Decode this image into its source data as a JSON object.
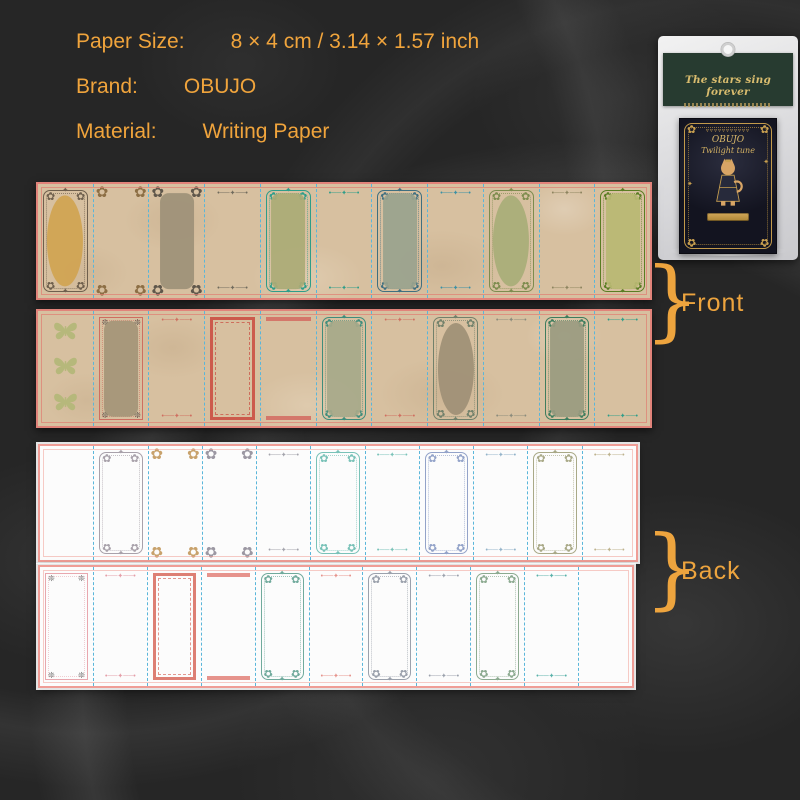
{
  "info": {
    "rows": [
      {
        "label": "Paper Size:",
        "value": "8 × 4 cm / 3.14 × 1.57 inch"
      },
      {
        "label": "Brand:",
        "value": "OBUJO"
      },
      {
        "label": "Material:",
        "value": "Writing Paper"
      }
    ]
  },
  "package": {
    "header_title": "The stars sing forever",
    "notepad_brand": "OBUJO",
    "notepad_series": "Twilight tune"
  },
  "annotations": {
    "front": "Front",
    "back": "Back",
    "brace": "}"
  },
  "ornaments": {
    "corner": "✿",
    "star": "✦",
    "line": "•──✦──•",
    "snow": "❊",
    "bunting": "▿▿▿▿▿▿▿▿▿▿▿"
  },
  "colors": {
    "accent_orange": "#eda43e",
    "kraft_paper": "#d7c0a0",
    "strip_border_red": "#e1837a",
    "divider_blue": "#5ab6da",
    "back_paper": "#fcfcfc",
    "card_green": "#273b30",
    "gold": "#c9a050",
    "notepad_dark": "#131420"
  },
  "strips": [
    {
      "name": "front-strip-top",
      "panels": [
        {
          "t": "ornate",
          "f": "#6e5f4d",
          "c": "oval",
          "cc": "#d1a452"
        },
        {
          "t": "corner",
          "f": "#8d6f45"
        },
        {
          "t": "corner",
          "f": "#5f574b",
          "c": "rrect",
          "cc": "#9e9179"
        },
        {
          "t": "line",
          "f": "#6f6a5c"
        },
        {
          "t": "ornate",
          "f": "#2e9d89",
          "c": "rrect",
          "cc": "#abab76"
        },
        {
          "t": "line",
          "f": "#2e9d89"
        },
        {
          "t": "ornate",
          "f": "#3f6f80",
          "c": "rrect",
          "cc": "#9aa38e"
        },
        {
          "t": "line",
          "f": "#3a90a5"
        },
        {
          "t": "ornate",
          "f": "#7d8c4e",
          "c": "oval",
          "cc": "#a9ad78"
        },
        {
          "t": "line",
          "f": "#8d845f"
        },
        {
          "t": "ornate",
          "f": "#5a7d22",
          "c": "rrect",
          "cc": "#b9b873"
        }
      ]
    },
    {
      "name": "front-strip-bottom",
      "panels": [
        {
          "t": "butterflies",
          "f": "#b6b87b"
        },
        {
          "t": "rectcorner",
          "f": "#cf6e60",
          "cg": "#55504a",
          "c": "rrect",
          "cc": "#a59478"
        },
        {
          "t": "line",
          "f": "#cf6e60"
        },
        {
          "t": "rect",
          "f": "#cc5a4c"
        },
        {
          "t": "bars",
          "f": "#d4776a"
        },
        {
          "t": "ornate",
          "f": "#3f8d7c",
          "c": "rrect",
          "cc": "#a7a98a"
        },
        {
          "t": "line",
          "f": "#cf6e60"
        },
        {
          "t": "ornate",
          "f": "#72816b",
          "c": "oval",
          "cc": "#9f9076"
        },
        {
          "t": "line",
          "f": "#8b8b7c"
        },
        {
          "t": "ornate",
          "f": "#3e7d5e",
          "c": "rrect",
          "cc": "#9a9b80"
        },
        {
          "t": "line",
          "f": "#2e9d89"
        }
      ]
    },
    {
      "name": "back-strip-top",
      "panels": [
        {
          "t": "none"
        },
        {
          "t": "ornate",
          "f": "#a8a1aa"
        },
        {
          "t": "corner",
          "f": "#c8a26c"
        },
        {
          "t": "corner",
          "f": "#9c98a3"
        },
        {
          "t": "line",
          "f": "#a3a3ab"
        },
        {
          "t": "ornate",
          "f": "#79c2b8"
        },
        {
          "t": "line",
          "f": "#79c2b8"
        },
        {
          "t": "ornate",
          "f": "#93a3c9"
        },
        {
          "t": "line",
          "f": "#93b3c9"
        },
        {
          "t": "ornate",
          "f": "#a9a987"
        },
        {
          "t": "line",
          "f": "#bdb28d"
        }
      ]
    },
    {
      "name": "back-strip-bottom",
      "panels": [
        {
          "t": "rectcorner",
          "f": "#e8a7ae",
          "cg": "#6a6a6a"
        },
        {
          "t": "line",
          "f": "#e49ea8"
        },
        {
          "t": "rect",
          "f": "#dd7f74"
        },
        {
          "t": "bars",
          "f": "#e6938c"
        },
        {
          "t": "ornate",
          "f": "#70aa9c"
        },
        {
          "t": "line",
          "f": "#e6938c"
        },
        {
          "t": "ornate",
          "f": "#9ba1ac"
        },
        {
          "t": "line",
          "f": "#9ba1ac"
        },
        {
          "t": "ornate",
          "f": "#8caa90"
        },
        {
          "t": "line",
          "f": "#58b1a9"
        },
        {
          "t": "none"
        }
      ]
    }
  ]
}
